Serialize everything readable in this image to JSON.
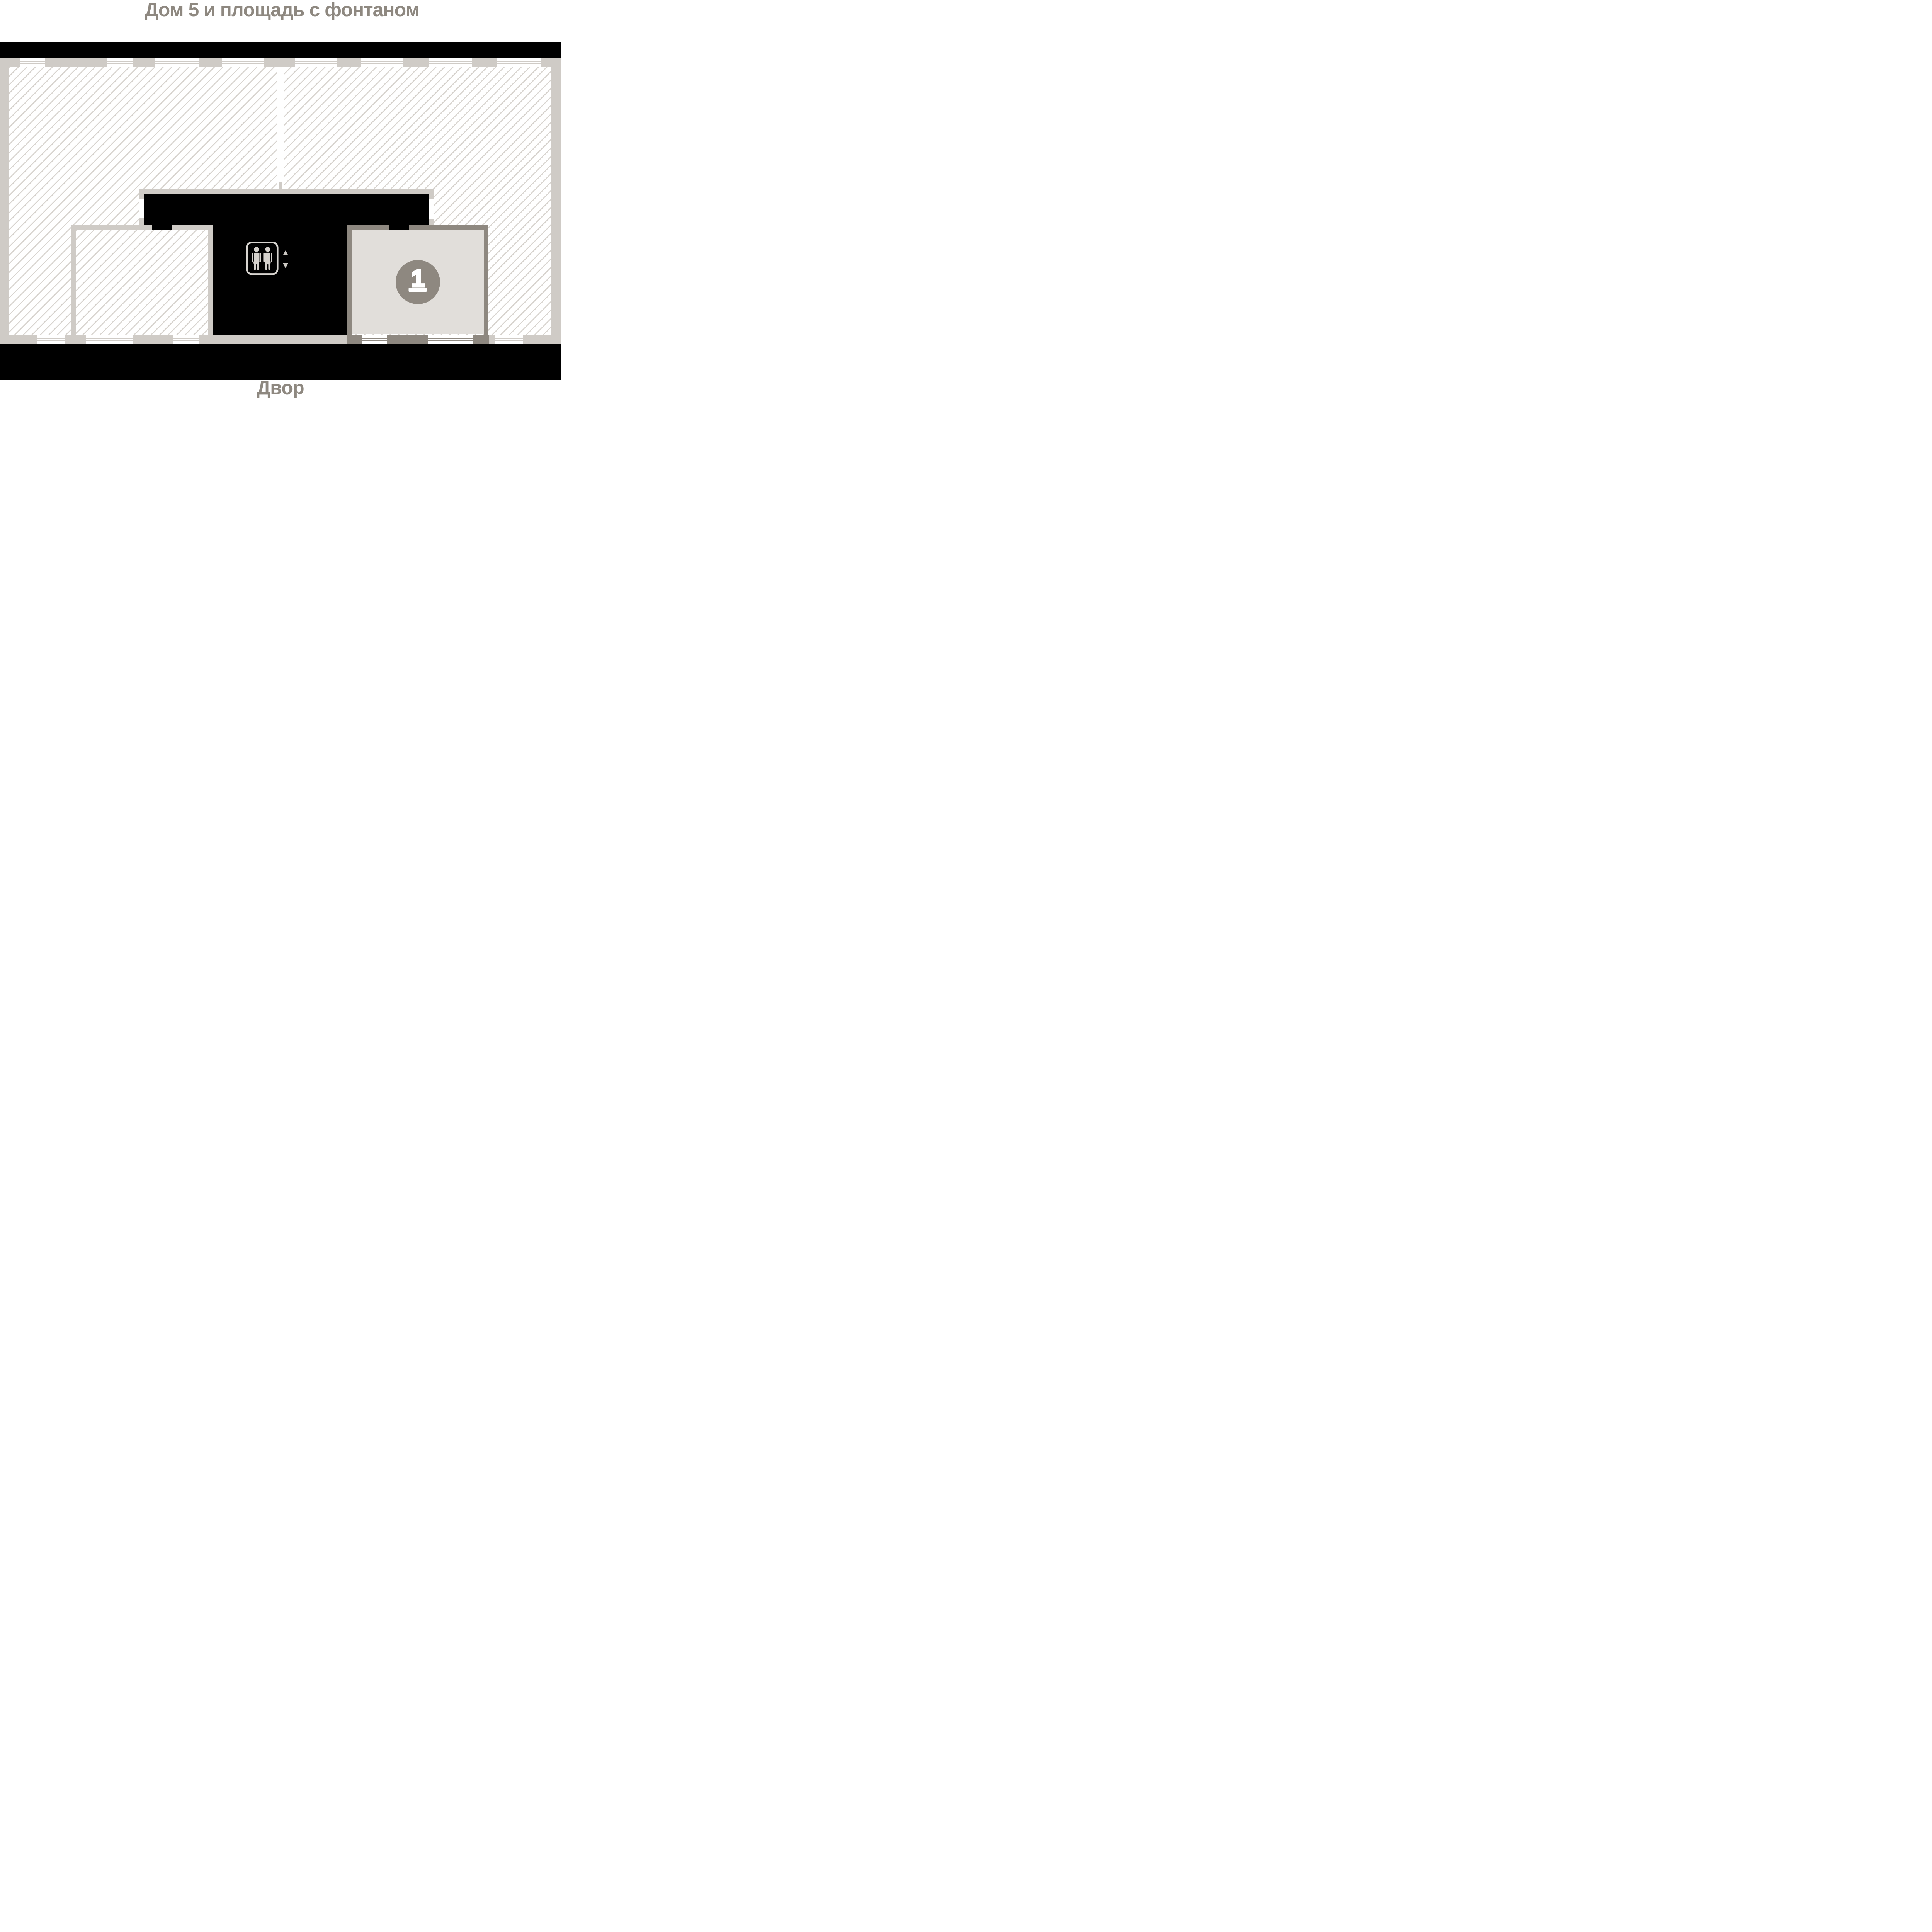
{
  "header": {
    "title": "Дом 5 и площадь с фонтаном"
  },
  "footer": {
    "courtyard_label": "Двор"
  },
  "plan": {
    "unit": {
      "number": "1"
    },
    "icons": {
      "elevator": "elevator-icon",
      "up_arrow": "triangle-up-icon",
      "down_arrow": "triangle-down-icon"
    }
  },
  "colors": {
    "background": "#ffffff",
    "black_core": "#000000",
    "wall_light": "#cfcbc6",
    "wall_dark": "#8e8880",
    "hatch_line": "#d7d3ce",
    "unit_fill": "#e1deda",
    "icon_gray": "#d5d1cc",
    "text_gray": "#8e8880",
    "badge_fill": "#8e8880",
    "badge_number": "#ffffff"
  }
}
